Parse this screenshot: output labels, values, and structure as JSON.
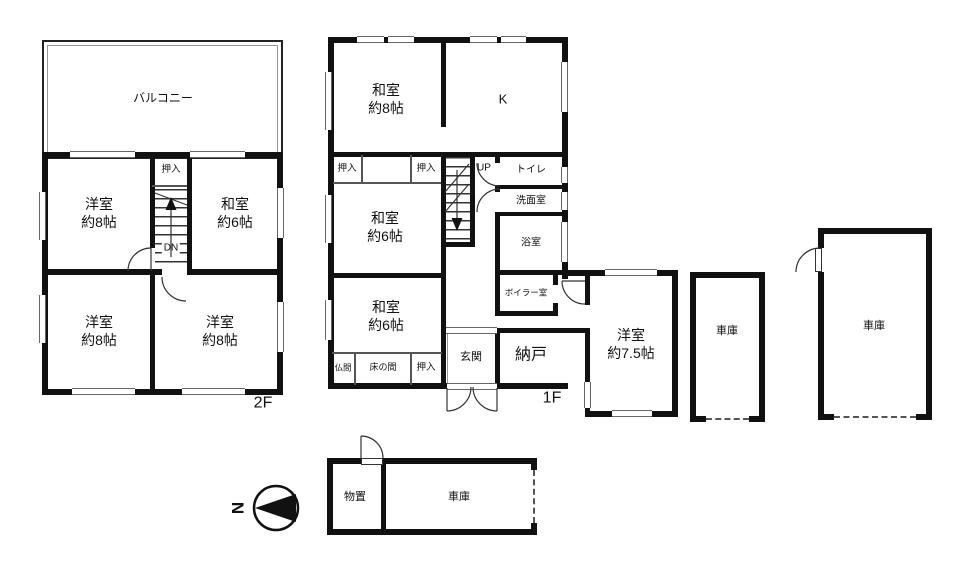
{
  "title": "間取り図",
  "colors": {
    "wall": "#111111",
    "thin_line": "#666666",
    "background": "#ffffff"
  },
  "compass": {
    "north": "N"
  },
  "floor2": {
    "label": "2F",
    "rooms": {
      "balcony": "バルコニー",
      "western_nw": {
        "name": "洋室",
        "size": "約8帖"
      },
      "japanese_ne": {
        "name": "和室",
        "size": "約6帖"
      },
      "closet": "押入",
      "stairs_dn": "DN",
      "western_sw": {
        "name": "洋室",
        "size": "約8帖"
      },
      "western_se": {
        "name": "洋室",
        "size": "約8帖"
      }
    }
  },
  "floor1": {
    "label": "1F",
    "rooms": {
      "japanese8": {
        "name": "和室",
        "size": "約8帖"
      },
      "kitchen": "K",
      "closet_a": "押入",
      "closet_b": "押入",
      "stairs_up": "UP",
      "toilet": "トイレ",
      "washroom": "洗面室",
      "bathroom": "浴室",
      "boiler": "ボイラー室",
      "japanese6_mid": {
        "name": "和室",
        "size": "約6帖"
      },
      "japanese6_low": {
        "name": "和室",
        "size": "約6帖"
      },
      "butsuma": "仏間",
      "tokonoma": "床の間",
      "closet_c": "押入",
      "entrance": "玄関",
      "storeroom": "納戸",
      "western75": {
        "name": "洋室",
        "size": "約7.5帖"
      }
    }
  },
  "garages": {
    "garage_a": "車庫",
    "garage_b": "車庫"
  },
  "annex": {
    "shed": "物置",
    "garage": "車庫"
  }
}
